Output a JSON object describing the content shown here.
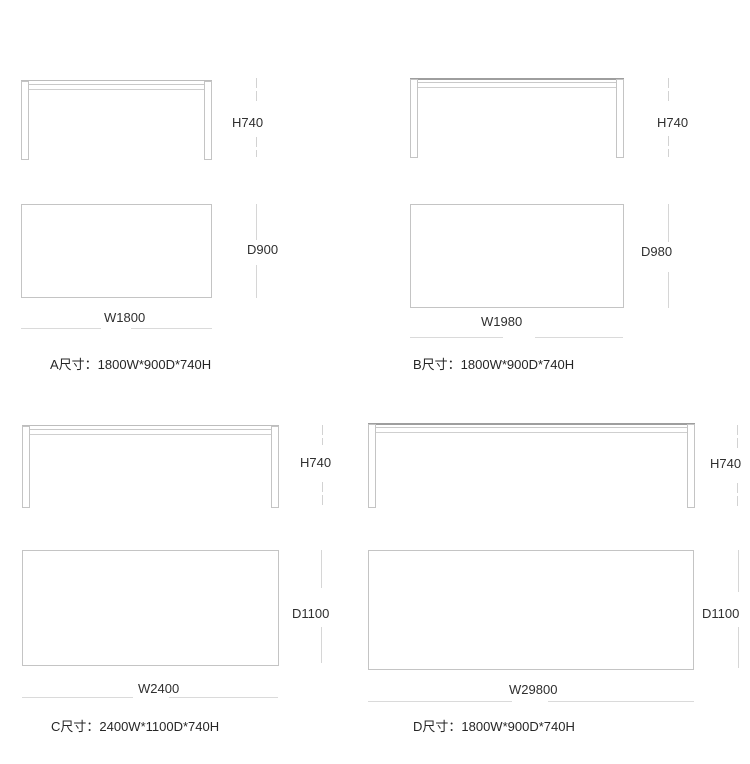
{
  "colors": {
    "background": "#ffffff",
    "outline": "#c4c4c4",
    "tabletop_edge": "#9e9e9e",
    "dimension_line": "#d6d6d6",
    "text": "#2f2f2f"
  },
  "panels": [
    {
      "id": "A",
      "height_label": "H740",
      "depth_label": "D900",
      "width_label": "W1800",
      "caption": "A尺寸：1800W*900D*740H"
    },
    {
      "id": "B",
      "height_label": "H740",
      "depth_label": "D980",
      "width_label": "W1980",
      "caption": "B尺寸：1800W*900D*740H"
    },
    {
      "id": "C",
      "height_label": "H740",
      "depth_label": "D1100",
      "width_label": "W2400",
      "caption": "C尺寸：2400W*1100D*740H"
    },
    {
      "id": "D",
      "height_label": "H740",
      "depth_label": "D1100",
      "width_label": "W29800",
      "caption": "D尺寸：1800W*900D*740H"
    }
  ]
}
